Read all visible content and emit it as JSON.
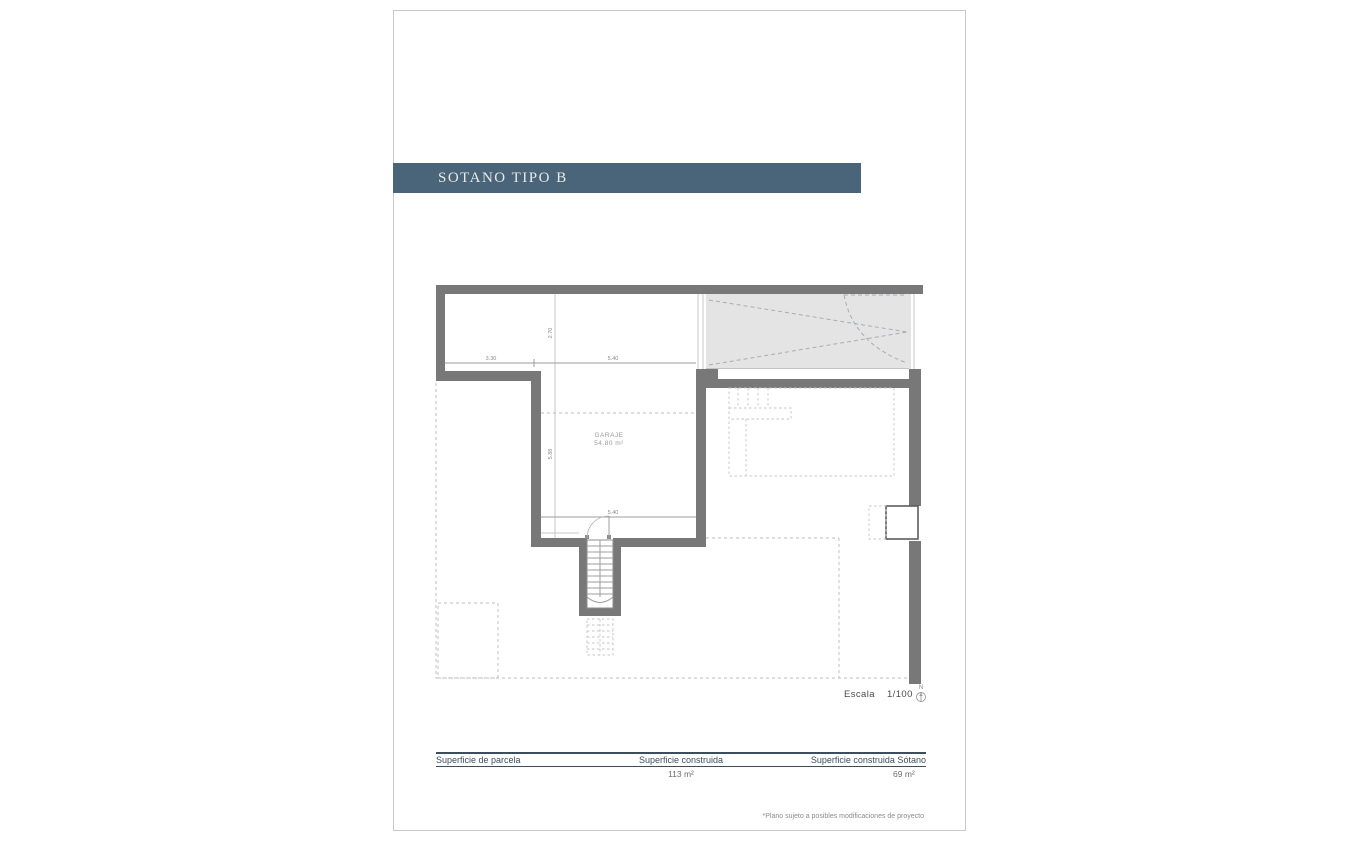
{
  "page": {
    "title": "SOTANO TIPO B",
    "accent_color": "#4a6579",
    "footnote": "*Plano sujeto a posibles modificaciones de proyecto"
  },
  "plan": {
    "room_label": "GARAJE",
    "room_area": "54.80 m²",
    "dimensions": {
      "top_left_width": "3.30",
      "top_right_width": "5.40",
      "upper_height": "2.70",
      "garage_height": "5.88",
      "bottom_width": "5.40"
    },
    "scale": {
      "label": "Escala",
      "value": "1/100"
    },
    "north_label": "N"
  },
  "table": {
    "columns": [
      {
        "header": "Superficie de parcela",
        "value": ""
      },
      {
        "header": "Superficie construida",
        "value": "113 m²"
      },
      {
        "header": "Superficie construida Sótano",
        "value": "69 m²"
      }
    ]
  }
}
